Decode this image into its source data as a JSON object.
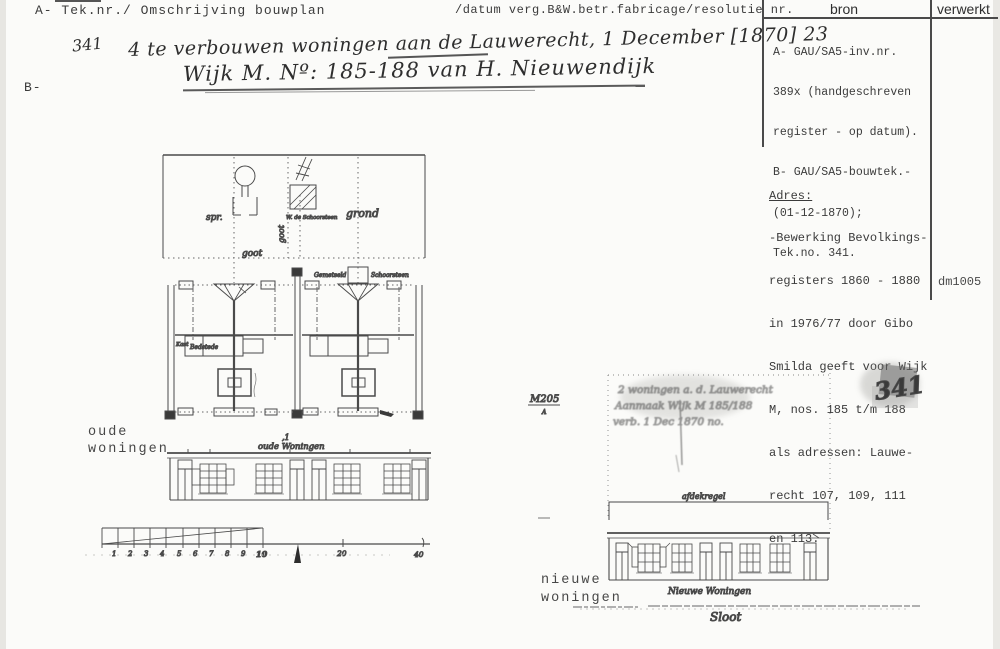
{
  "header": {
    "left_label": "A- Tek.nr./ Omschrijving bouwplan",
    "mid_label": "/datum verg.B&W.betr.fabricage/resolutie nr.",
    "b_label": "B-"
  },
  "bron_table": {
    "col1_header": "bron",
    "col2_header": "verwerkt",
    "bron_lines": [
      "A- GAU/SA5-inv.nr.",
      "389x (handgeschreven",
      "register - op datum).",
      "B- GAU/SA5-bouwtek.-",
      "(01-12-1870);",
      "Tek.no. 341."
    ],
    "adres_heading": "Adres:",
    "adres_lines": [
      "-Bewerking Bevolkings-",
      "registers 1860 - 1880",
      "in 1976/77 door Gibo",
      "Smilda geeft voor Wijk",
      "M, nos. 185 t/m 188",
      "als adressen: Lauwe-",
      "recht 107, 109, 111",
      "en 113."
    ],
    "code": "dm1005"
  },
  "handwritten": {
    "tek_nr": "341",
    "line1": "4 te verbouwen woningen aan de Lauwerecht, 1 December [1870] 23",
    "line2": "Wijk M. Nº: 185-188 van H. Nieuwendijk"
  },
  "old_drawing": {
    "label_line1": "oude",
    "label_line2": "woningen",
    "cursive_title": "oude Woningen",
    "annotations": {
      "spr": "spr.",
      "goot_vertical": "goot",
      "goot_horizontal": "goot",
      "grond": "grond",
      "chimney_note": "W. de Schoorsteen",
      "gemetseld": "Gemetseld",
      "schoorsteen": "Schoorsteen",
      "kast": "Kast",
      "bedstede": "Bedstede",
      "mark": ",1"
    },
    "scale_numbers": [
      "1",
      "2",
      "3",
      "4",
      "5",
      "6",
      "7",
      "8",
      "9",
      "10"
    ],
    "scale_mid": "20",
    "scale_end": "40"
  },
  "new_drawing": {
    "label_line1": "nieuwe",
    "label_line2": "woningen",
    "cursive_title": "Nieuwe Woningen",
    "sloot_label": "Sloot",
    "parapet_label": "afdekregel",
    "stamp": "341",
    "corner_note": "M205",
    "corner_note_sub": "A",
    "faded_lines": [
      "2 woningen a. d. Lauwerecht",
      "Aanmaak Wijk M 185/188",
      "verb. 1 Dec 1870 no."
    ]
  },
  "colors": {
    "paper": "#fbfbf9",
    "ink": "#3a3a3a",
    "drawing": "#4a4a4a"
  }
}
